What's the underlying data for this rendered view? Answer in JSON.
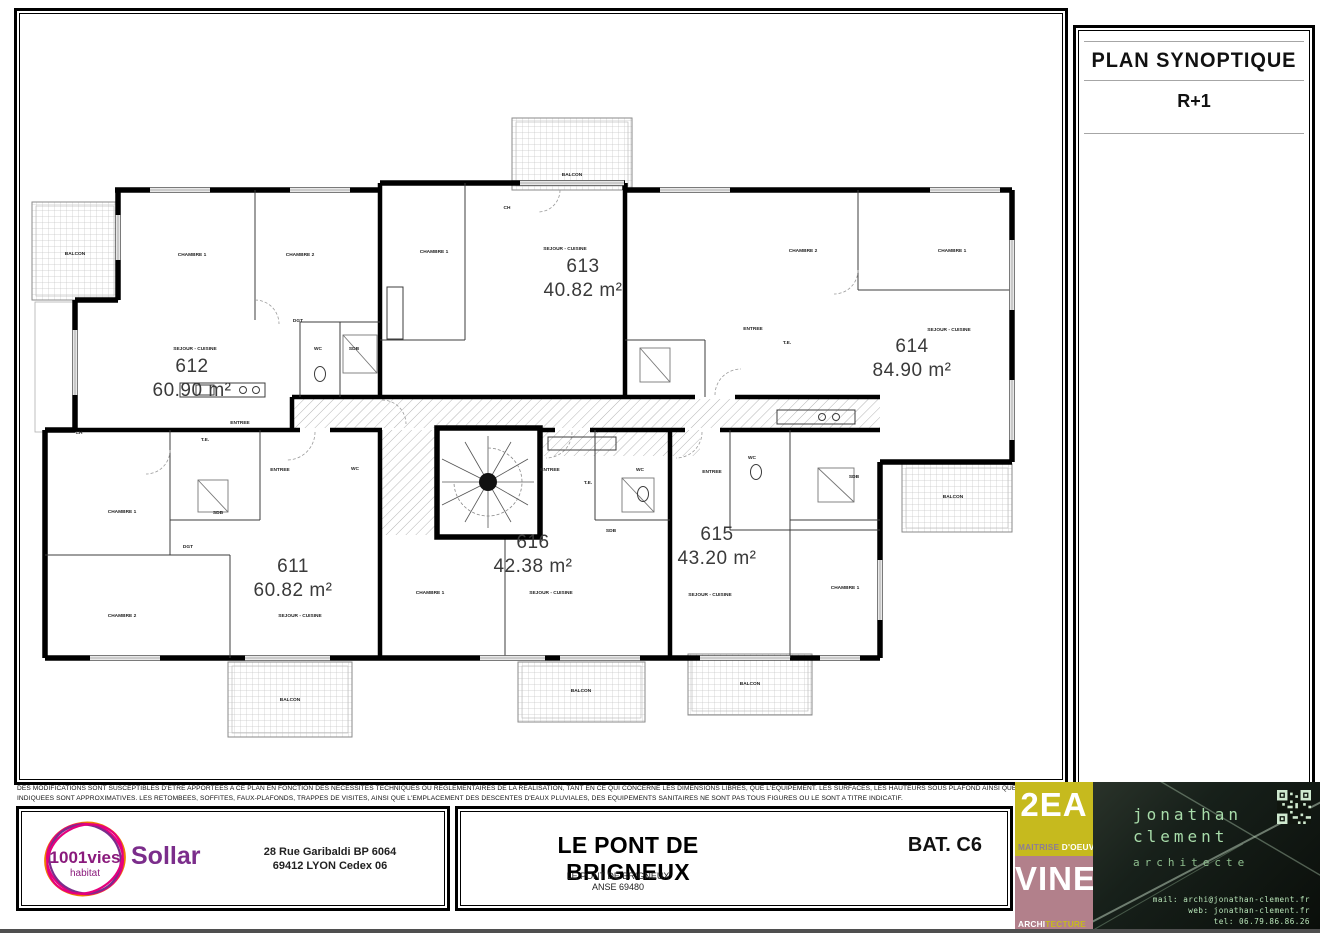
{
  "title_block": {
    "title": "PLAN SYNOPTIQUE",
    "level": "R+1"
  },
  "disclaimer": {
    "line1": "DES MODIFICATIONS SONT SUSCEPTIBLES D'ETRE APPORTEES A CE PLAN EN FONCTION DES NECESSITES TECHNIQUES OU REGLEMENTAIRES DE LA REALISATION, TANT EN CE QUI CONCERNE LES DIMENSIONS LIBRES, QUE L'EQUIPEMENT. LES SURFACES, LES HAUTEURS SOUS PLAFOND AINSI QUE LES HAUTEURS DE SEUILS",
    "line2": "INDIQUEES SONT APPROXIMATIVES. LES RETOMBEES, SOFFITES, FAUX-PLAFONDS, TRAPPES DE VISITES, AINSI QUE L'EMPLACEMENT DES DESCENTES D'EAUX PLUVIALES, DES EQUIPEMENTS SANITAIRES NE SONT PAS TOUS FIGURES OU LE SONT A TITRE INDICATIF."
  },
  "footer": {
    "logo_brand": "1001vies",
    "logo_sub": "habitat",
    "logo_company": "Sollar",
    "address_line1": "28 Rue Garibaldi BP 6064",
    "address_line2": "69412 LYON Cedex 06",
    "project_title": "LE PONT DE BRIGNEUX",
    "building": "BAT. C6",
    "project_sub1": "LE PONT DE BRIGNEUX",
    "project_sub2": "ANSE 69480"
  },
  "agency": {
    "block1_title": "2EA",
    "block1_sub_a": "MAITRISE",
    "block1_sub_b": " D'OEUVRE",
    "block2_title": "VINE",
    "block2_sub_a": "ARCHI",
    "block2_sub_b": "TECTURE",
    "name_line1": "jonathan",
    "name_line2": "clement",
    "role": "architecte",
    "mail": "mail: archi@jonathan-clement.fr",
    "web": "web: jonathan-clement.fr",
    "tel": "tel: 06.79.86.86.26"
  },
  "colors": {
    "logo_orange": "#ef7d00",
    "logo_magenta": "#e5007d",
    "logo_purple": "#7b2d8b",
    "block_yellow": "#c6ba1e",
    "block_mauve": "#b2808b",
    "card_green": "#a8dcaa"
  },
  "plan": {
    "apartments": [
      {
        "number": "612",
        "area": "60.90 m²",
        "x": 192,
        "y": 372
      },
      {
        "number": "613",
        "area": "40.82 m²",
        "x": 583,
        "y": 272
      },
      {
        "number": "614",
        "area": "84.90 m²",
        "x": 912,
        "y": 352
      },
      {
        "number": "611",
        "area": "60.82 m²",
        "x": 293,
        "y": 572
      },
      {
        "number": "616",
        "area": "42.38 m²",
        "x": 533,
        "y": 548
      },
      {
        "number": "615",
        "area": "43.20 m²",
        "x": 717,
        "y": 540
      }
    ],
    "rooms": [
      {
        "name": "BALCON",
        "x": 75,
        "y": 255
      },
      {
        "name": "CHAMBRE 1",
        "x": 192,
        "y": 256
      },
      {
        "name": "CHAMBRE 2",
        "x": 300,
        "y": 256
      },
      {
        "name": "DGT",
        "x": 298,
        "y": 322
      },
      {
        "name": "SEJOUR - CUISINE",
        "x": 195,
        "y": 350
      },
      {
        "name": "WC",
        "x": 318,
        "y": 350
      },
      {
        "name": "SDB",
        "x": 354,
        "y": 350
      },
      {
        "name": "ENTREE",
        "x": 240,
        "y": 424
      },
      {
        "name": "T.E.",
        "x": 205,
        "y": 441
      },
      {
        "name": "CH",
        "x": 79,
        "y": 434
      },
      {
        "name": "CHAMBRE 1",
        "x": 434,
        "y": 253
      },
      {
        "name": "CH",
        "x": 507,
        "y": 209
      },
      {
        "name": "BALCON",
        "x": 572,
        "y": 176
      },
      {
        "name": "SEJOUR - CUISINE",
        "x": 565,
        "y": 250
      },
      {
        "name": "CHAMBRE 2",
        "x": 803,
        "y": 252
      },
      {
        "name": "CHAMBRE 1",
        "x": 952,
        "y": 252
      },
      {
        "name": "ENTREE",
        "x": 753,
        "y": 330
      },
      {
        "name": "T.E.",
        "x": 787,
        "y": 344
      },
      {
        "name": "SEJOUR - CUISINE",
        "x": 949,
        "y": 331
      },
      {
        "name": "WC",
        "x": 752,
        "y": 459
      },
      {
        "name": "SDB",
        "x": 854,
        "y": 478
      },
      {
        "name": "BALCON",
        "x": 953,
        "y": 498
      },
      {
        "name": "ENTREE",
        "x": 550,
        "y": 471
      },
      {
        "name": "WC",
        "x": 640,
        "y": 471
      },
      {
        "name": "T.E.",
        "x": 588,
        "y": 484
      },
      {
        "name": "SDB",
        "x": 611,
        "y": 532
      },
      {
        "name": "CHAMBRE 1",
        "x": 430,
        "y": 594
      },
      {
        "name": "SEJOUR - CUISINE",
        "x": 551,
        "y": 594
      },
      {
        "name": "BALCON",
        "x": 581,
        "y": 692
      },
      {
        "name": "ENTREE",
        "x": 712,
        "y": 473
      },
      {
        "name": "SEJOUR - CUISINE",
        "x": 710,
        "y": 596
      },
      {
        "name": "CHAMBRE 1",
        "x": 845,
        "y": 589
      },
      {
        "name": "BALCON",
        "x": 750,
        "y": 685
      },
      {
        "name": "CHAMBRE 1",
        "x": 122,
        "y": 513
      },
      {
        "name": "SDB",
        "x": 218,
        "y": 514
      },
      {
        "name": "DGT",
        "x": 188,
        "y": 548
      },
      {
        "name": "ENTREE",
        "x": 280,
        "y": 471
      },
      {
        "name": "WC",
        "x": 355,
        "y": 470
      },
      {
        "name": "CHAMBRE 2",
        "x": 122,
        "y": 617
      },
      {
        "name": "SEJOUR - CUISINE",
        "x": 300,
        "y": 617
      },
      {
        "name": "BALCON",
        "x": 290,
        "y": 701
      }
    ]
  }
}
